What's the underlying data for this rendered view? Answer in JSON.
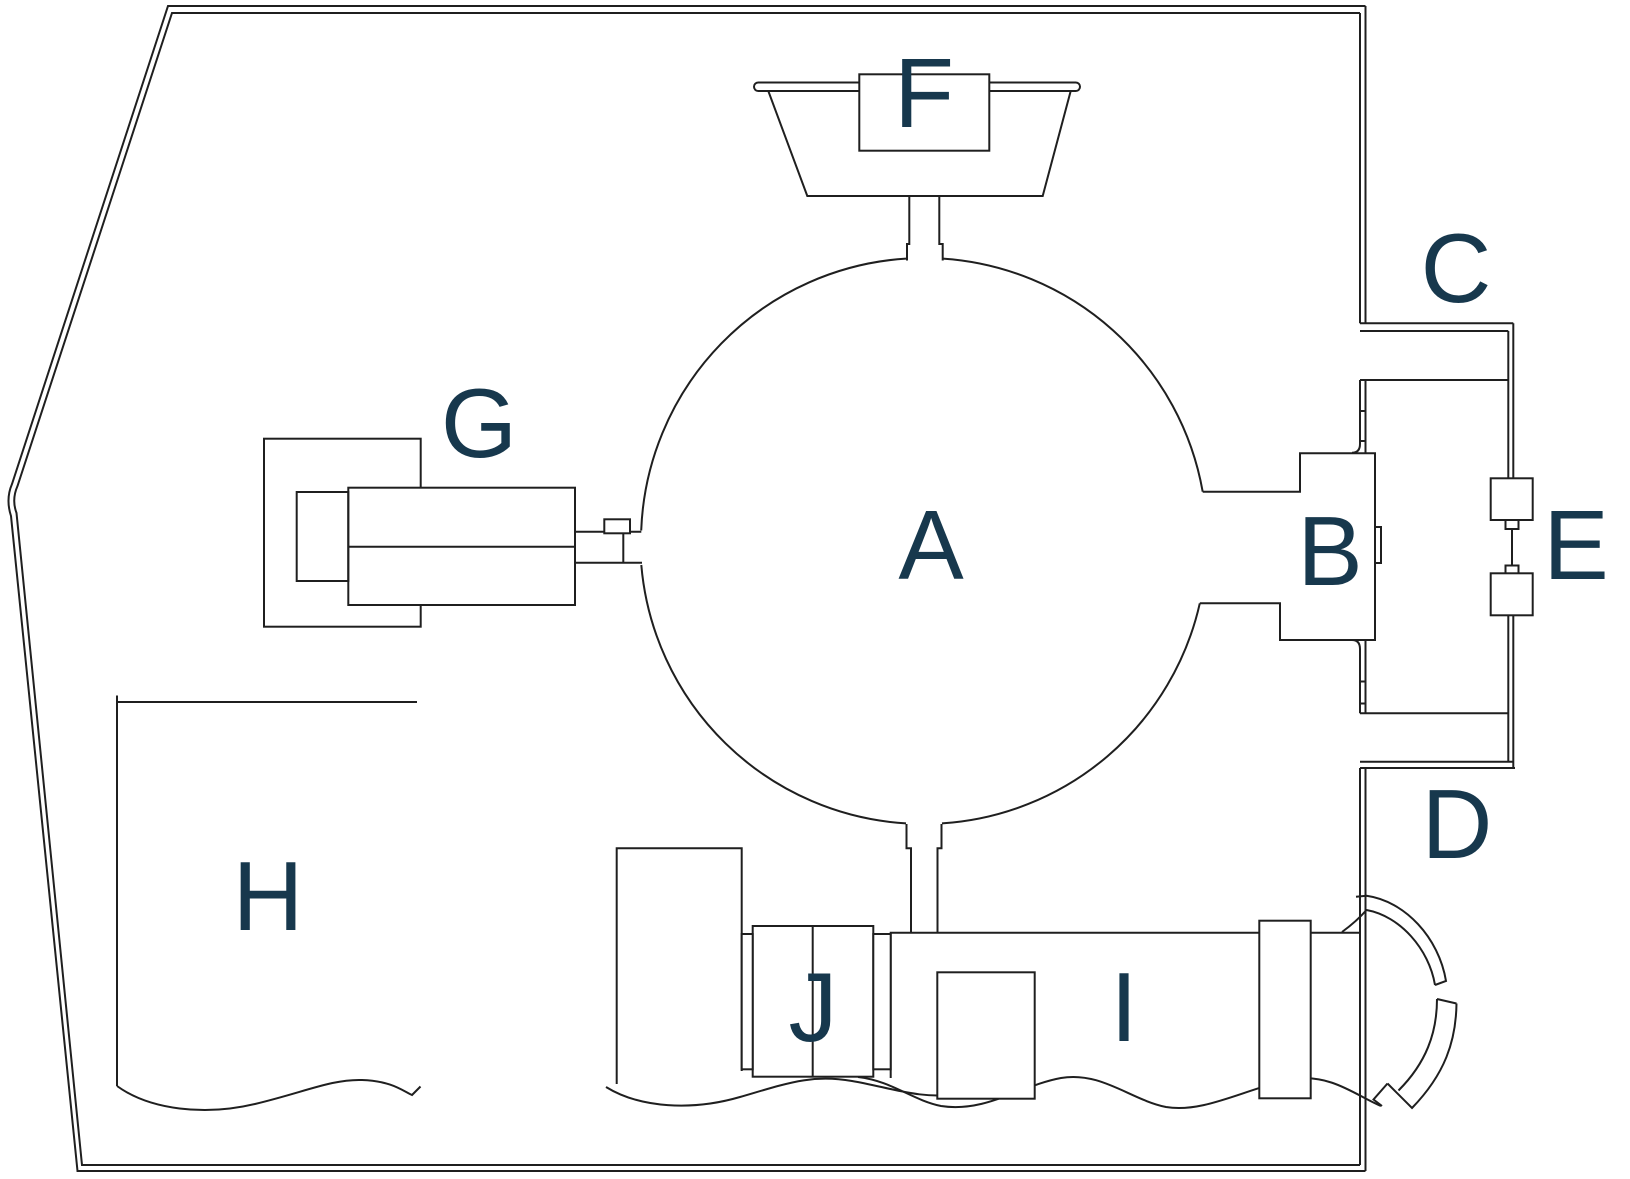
{
  "diagram_type": "equipment-floor-plan",
  "colors": {
    "background": "#ffffff",
    "line": "#1f1f1f",
    "label": "#17384d"
  },
  "labels": {
    "a": "A",
    "b": "B",
    "c": "C",
    "d": "D",
    "e": "E",
    "f": "F",
    "g": "G",
    "h": "H",
    "i": "I",
    "j": "J"
  }
}
